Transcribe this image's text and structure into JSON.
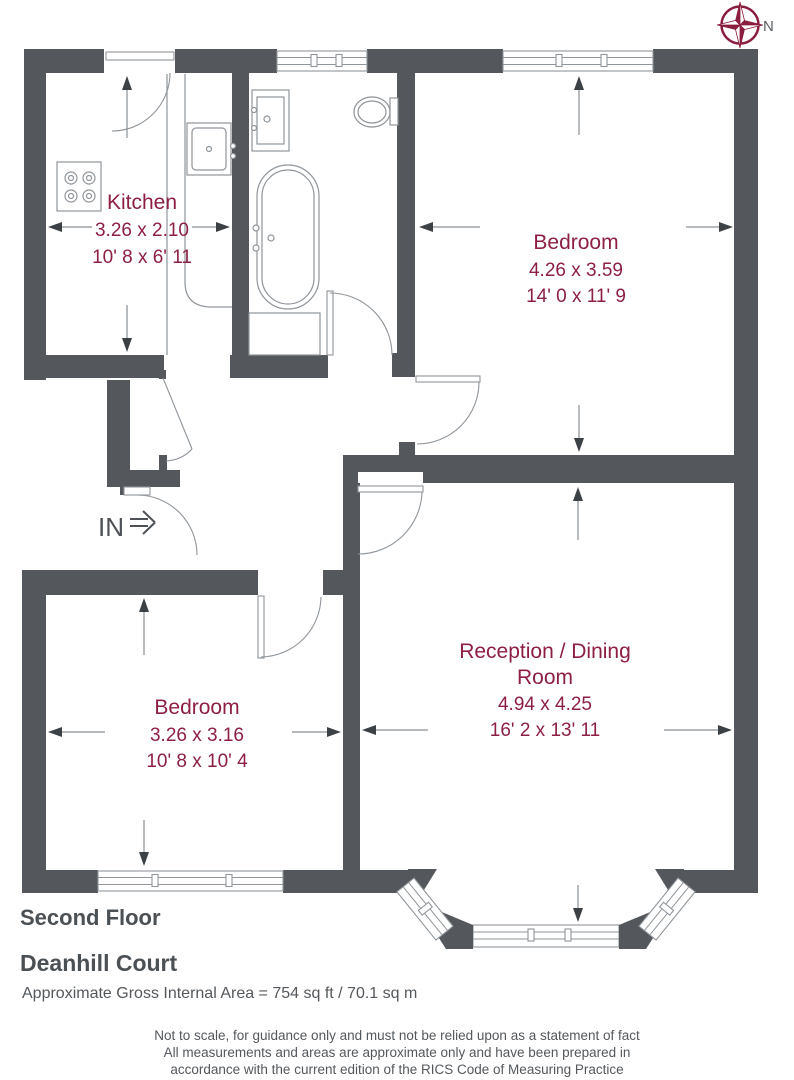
{
  "compass": {
    "north_label": "N"
  },
  "entrance": {
    "label": "IN"
  },
  "rooms": {
    "kitchen": {
      "name": "Kitchen",
      "metric": "3.26 x 2.10",
      "imperial": "10' 8 x 6' 11"
    },
    "bedroom1": {
      "name": "Bedroom",
      "metric": "4.26 x 3.59",
      "imperial": "14' 0 x 11' 9"
    },
    "reception": {
      "name_line1": "Reception / Dining",
      "name_line2": "Room",
      "metric": "4.94 x 4.25",
      "imperial": "16' 2 x 13' 11"
    },
    "bedroom2": {
      "name": "Bedroom",
      "metric": "3.26 x 3.16",
      "imperial": "10' 8 x 10' 4"
    }
  },
  "footer": {
    "floor_label": "Second Floor",
    "property_name": "Deanhill Court",
    "area_text": "Approximate Gross Internal Area = 754 sq ft / 70.1 sq m",
    "disclaimer_line1": "Not to scale, for guidance only and must not be relied upon as a statement of fact",
    "disclaimer_line2": "All measurements and areas are approximate only and have been prepared in",
    "disclaimer_line3": "accordance with the current edition of the RICS Code of Measuring Practice"
  },
  "colors": {
    "wall": "#54585C",
    "room_text": "#8D1F45",
    "compass": "#8B1D3F",
    "label_text": "#4D5156",
    "line": "#8F959A"
  }
}
